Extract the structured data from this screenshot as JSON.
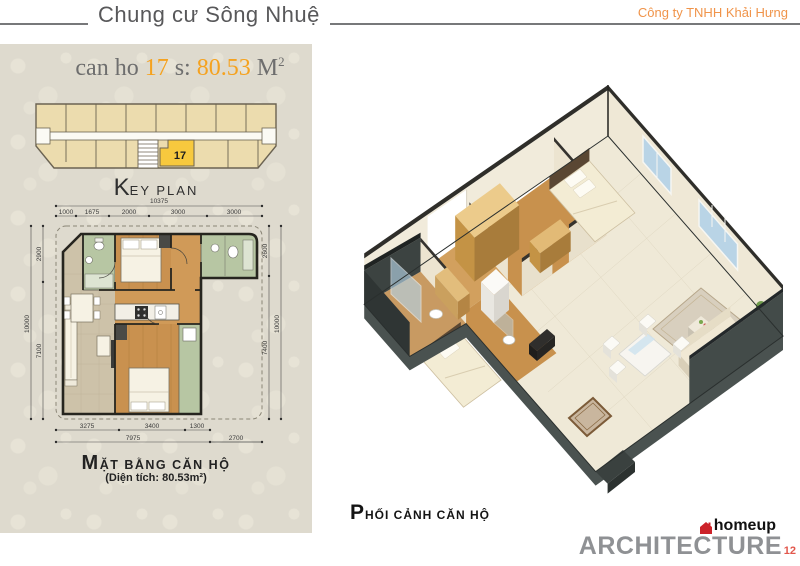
{
  "header": {
    "title": "Chung cư Sông Nhuệ",
    "company": "Công ty TNHH Khải Hưng"
  },
  "left_panel": {
    "unit_title": {
      "prefix": "can ho ",
      "number": "17",
      "s_label": " s: ",
      "area": "80.53",
      "unit": " M",
      "unit_sup": "2"
    },
    "key_plan": {
      "label_initial": "K",
      "label_rest": "EY PLAN",
      "unit_number": "17"
    },
    "floor_plan": {
      "label_initial": "M",
      "label_rest": "ẶT BẰNG CĂN HỘ",
      "area_note": "(Diện tích: 80.53m²)",
      "dims": {
        "top_total": "10375",
        "top_1": "1000",
        "top_2": "1675",
        "top_3": "2000",
        "top_4": "3000",
        "top_5": "3000",
        "left_1": "2900",
        "left_2": "7100",
        "left_total": "10000",
        "right_1": "2600",
        "right_2": "7400",
        "right_total": "10000",
        "bottom_1": "3275",
        "bottom_2": "3400",
        "bottom_3": "1300",
        "bottom_sub": "7975",
        "bottom_right": "2700"
      }
    }
  },
  "right_panel": {
    "label_initial": "P",
    "label_rest": "HỐI CẢNH CĂN HỘ"
  },
  "footer": {
    "brand": "homeup",
    "studio": "ARCHITECTURE",
    "page": "12"
  },
  "colors": {
    "accent_orange": "#f5a21f",
    "company_orange": "#f0944a",
    "panel_bg": "#dedace",
    "keyplan_unit": "#ecdcae",
    "keyplan_highlight": "#f7c93e",
    "plan_green": "#b7c6a3",
    "plan_wood": "#c9914f",
    "plan_tile": "#cdc2a9",
    "wall_dark": "#26251f",
    "architecture_gray": "#8f9194",
    "logo_red": "#cc2229",
    "page_red": "#e2574c"
  }
}
